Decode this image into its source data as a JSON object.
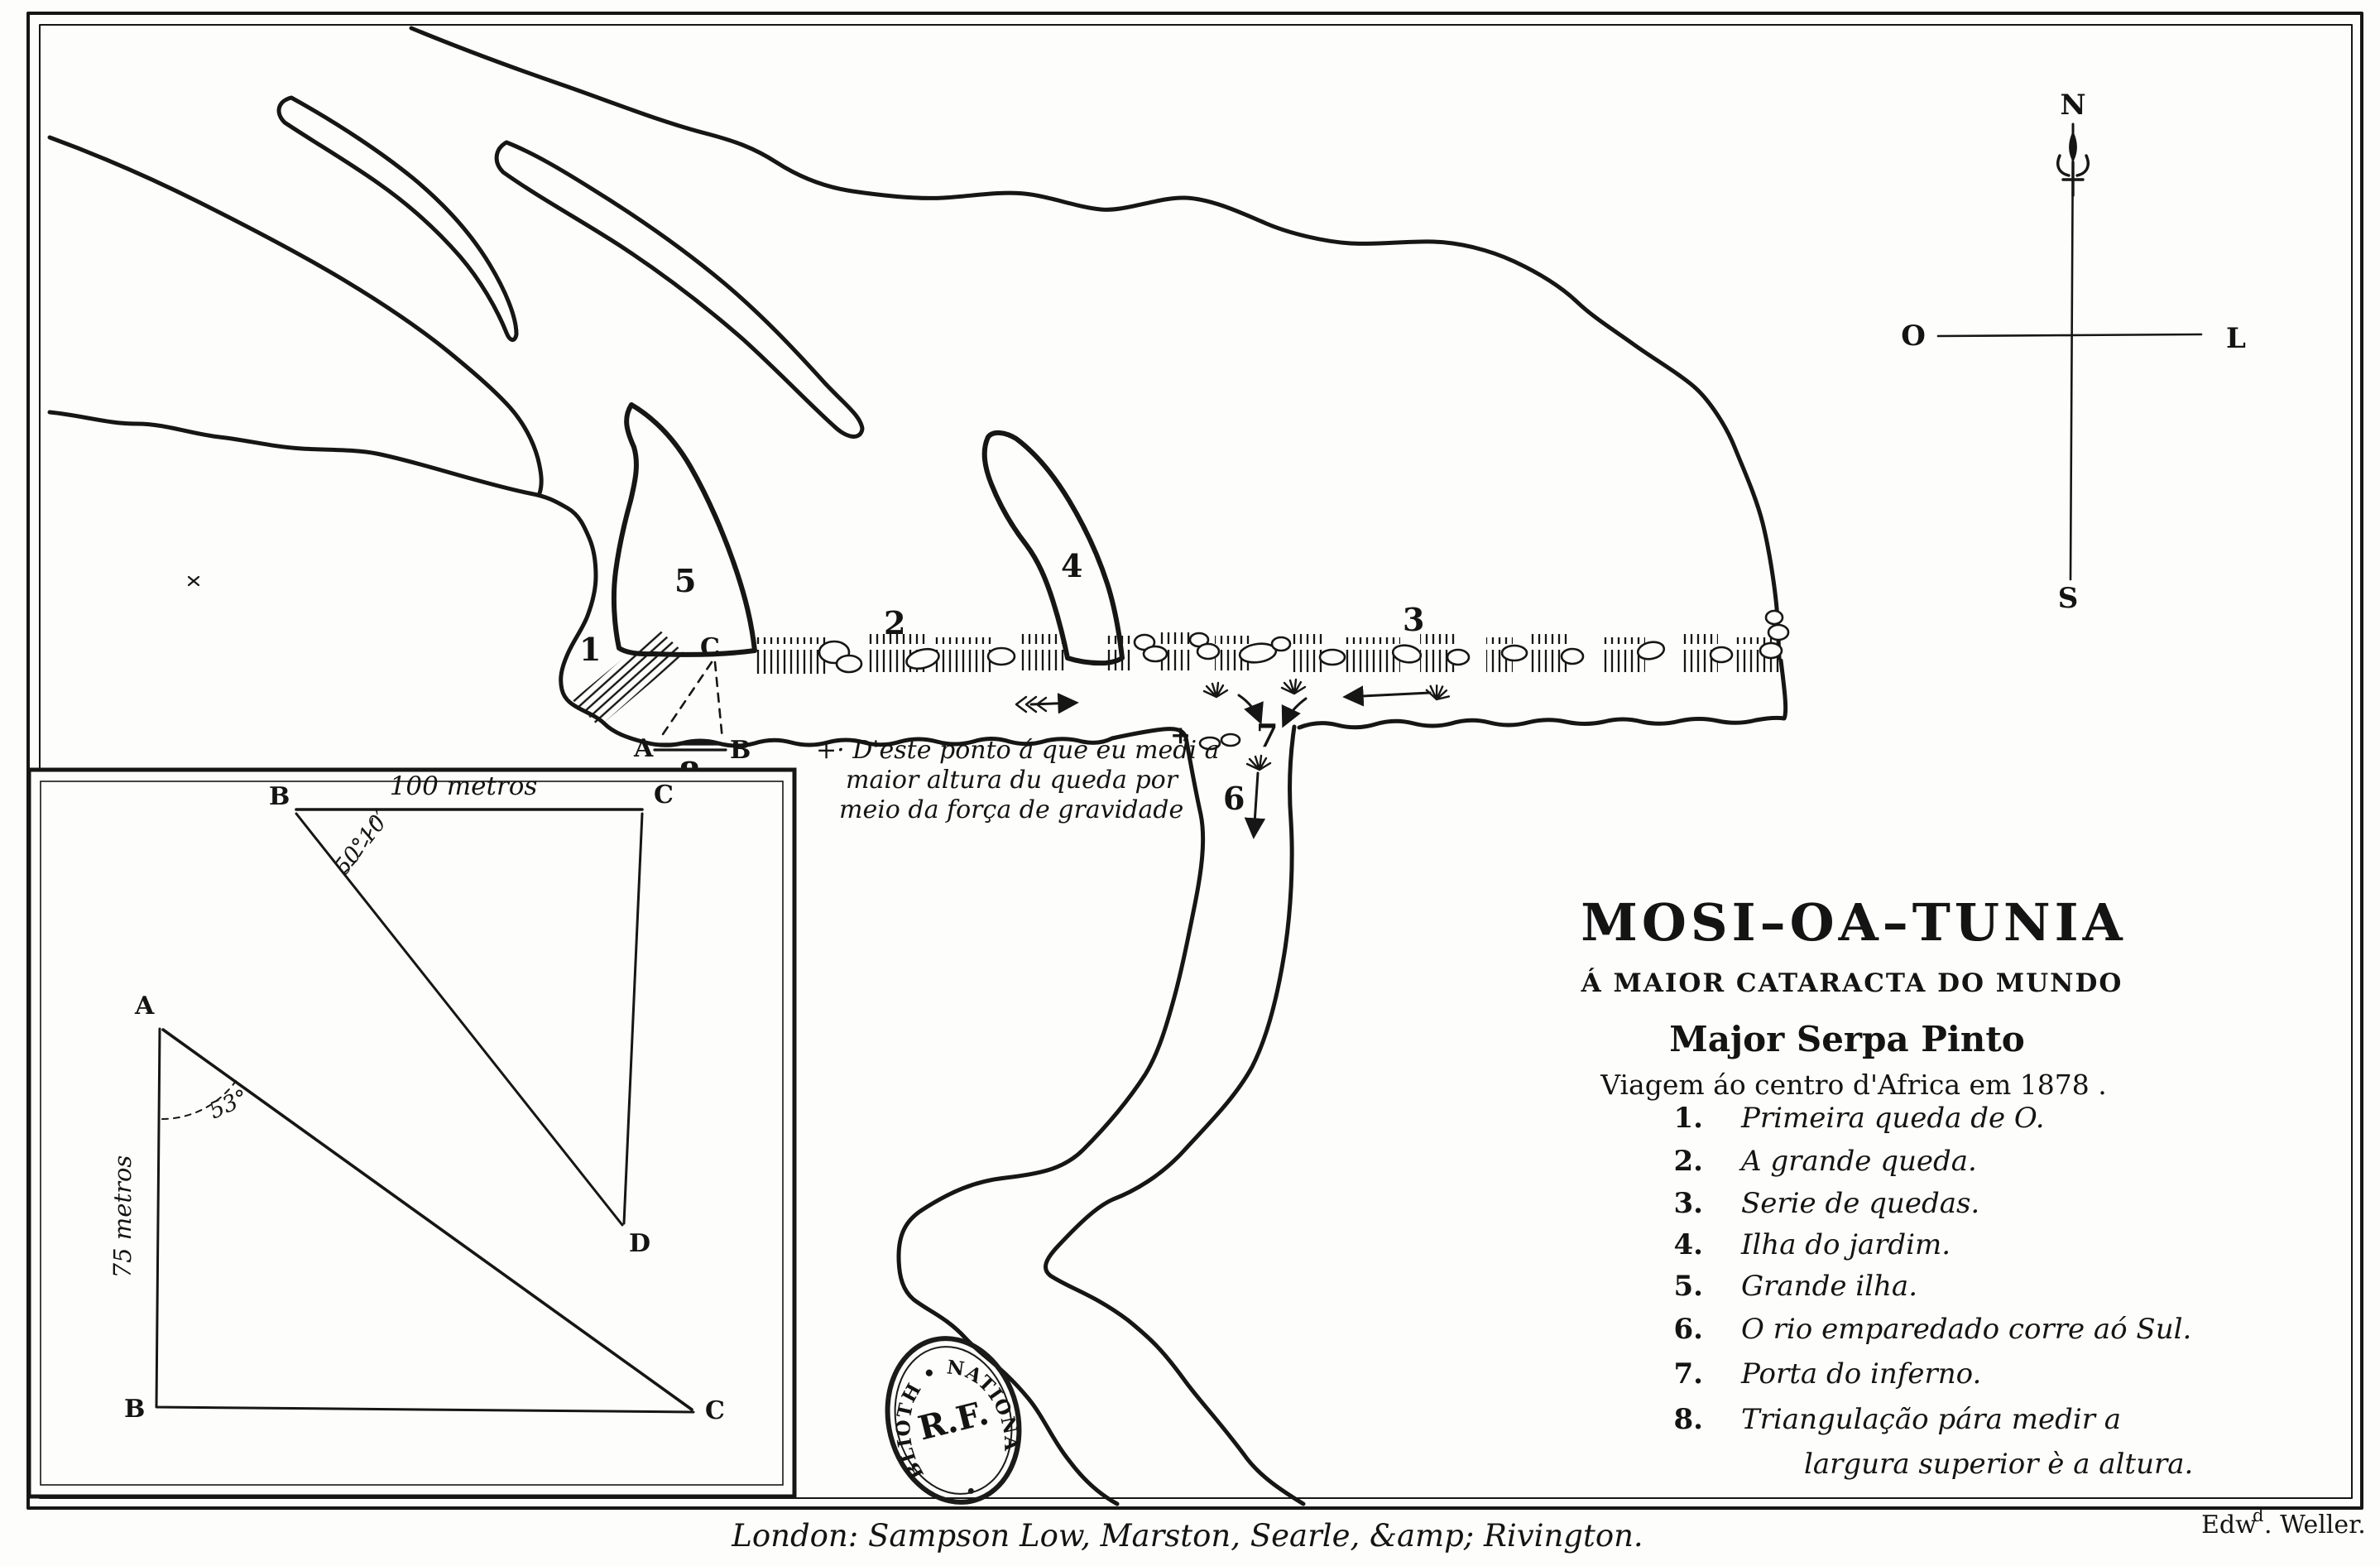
{
  "map": {
    "title": "MOSI–OA–TUNIA",
    "subtitle": "Á MAIOR CATARACTA DO MUNDO",
    "author": "Major Serpa Pinto",
    "edition": "Viagem áo centro d'Africa em 1878 .",
    "legend": [
      {
        "num": "1.",
        "text": "Primeira queda de O."
      },
      {
        "num": "2.",
        "text": "A grande queda."
      },
      {
        "num": "3.",
        "text": "Serie de quedas."
      },
      {
        "num": "4.",
        "text": "Ilha do jardim."
      },
      {
        "num": "5.",
        "text": "Grande ilha."
      },
      {
        "num": "6.",
        "text": "O rio emparedado corre aó Sul."
      },
      {
        "num": "7.",
        "text": "Porta do inferno."
      },
      {
        "num": "8.",
        "text": "Triangulação pára medir a",
        "text2": "largura superior è a altura."
      }
    ],
    "annotation": {
      "line1": "+· D'este ponto á que eu medi a",
      "line2": "maior altura du queda por",
      "line3": "meio da força de gravidade"
    },
    "compass": {
      "n": "N",
      "s": "S",
      "o": "O",
      "l": "L"
    },
    "points": {
      "f1": "1",
      "f2": "2",
      "f3": "3",
      "f4": "4",
      "f5": "5",
      "f6": "6",
      "f7": "7",
      "f8": "8",
      "tri_a": "A",
      "tri_b": "B",
      "tri_c": "C",
      "plus": "+"
    },
    "inset": {
      "pt_a": "A",
      "pt_b": "B",
      "pt_c": "C",
      "pt_d": "D",
      "scale_top": "100 metros",
      "angle_top": "50°10′",
      "side_left": "75 metros",
      "angle_bottom": "53°"
    },
    "stamp": {
      "arc_text": "BIBLIOTH • NATIONALE",
      "center_text": "R.F."
    },
    "imprint": "London: Sampson Low, Marston, Searle, &amp; Rivington.",
    "engraver": {
      "pre": "Edw",
      "sup": "d",
      "post": ". Weller."
    }
  }
}
